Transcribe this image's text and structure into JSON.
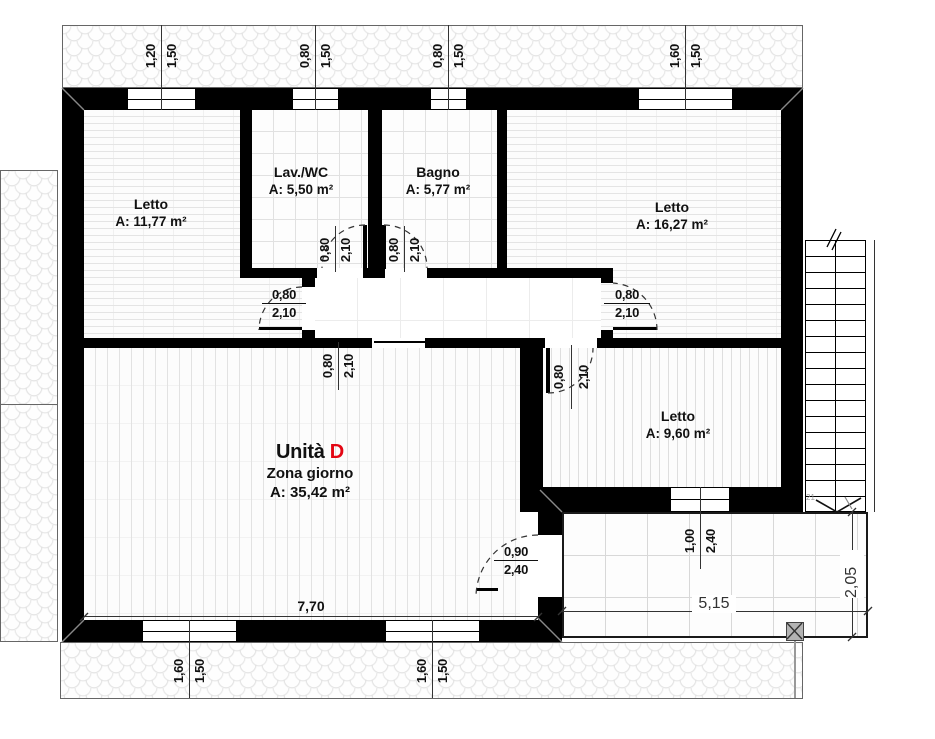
{
  "colors": {
    "accent_red": "#e30613",
    "wall": "#000000"
  },
  "rooms": {
    "letto_nw": {
      "name": "Letto",
      "area": "A: 11,77 m²"
    },
    "lav_wc": {
      "name": "Lav./WC",
      "area": "A: 5,50 m²"
    },
    "bagno": {
      "name": "Bagno",
      "area": "A: 5,77 m²"
    },
    "letto_ne": {
      "name": "Letto",
      "area": "A: 16,27 m²"
    },
    "letto_e": {
      "name": "Letto",
      "area": "A: 9,60 m²"
    },
    "zona_giorno": {
      "unit_prefix": "Unità ",
      "unit_letter": "D",
      "name": "Zona giorno",
      "area": "A: 35,42 m²"
    }
  },
  "openings": {
    "win_top_1": {
      "w": "1,20",
      "h": "1,50"
    },
    "win_top_2": {
      "w": "0,80",
      "h": "1,50"
    },
    "win_top_3": {
      "w": "0,80",
      "h": "1,50"
    },
    "win_top_4": {
      "w": "1,60",
      "h": "1,50"
    },
    "win_bottom_1": {
      "w": "1,60",
      "h": "1,50"
    },
    "win_bottom_2": {
      "w": "1,60",
      "h": "1,50"
    },
    "win_letto_e": {
      "w": "1,00",
      "h": "2,40"
    },
    "door_letto_nw": {
      "w": "0,80",
      "h": "2,10"
    },
    "door_lav_wc": {
      "w": "0,80",
      "h": "2,10"
    },
    "door_bagno": {
      "w": "0,80",
      "h": "2,10"
    },
    "door_letto_ne": {
      "w": "0,80",
      "h": "2,10"
    },
    "door_zona": {
      "w": "0,80",
      "h": "2,10"
    },
    "door_letto_e": {
      "w": "0,80",
      "h": "2,10"
    },
    "door_terrace": {
      "w": "0,90",
      "h": "2,40"
    }
  },
  "dimensions": {
    "zona_width": "7,70",
    "terrace_width": "5,15",
    "terrace_depth": "2,05"
  },
  "stairs": {
    "count_label": "21"
  }
}
